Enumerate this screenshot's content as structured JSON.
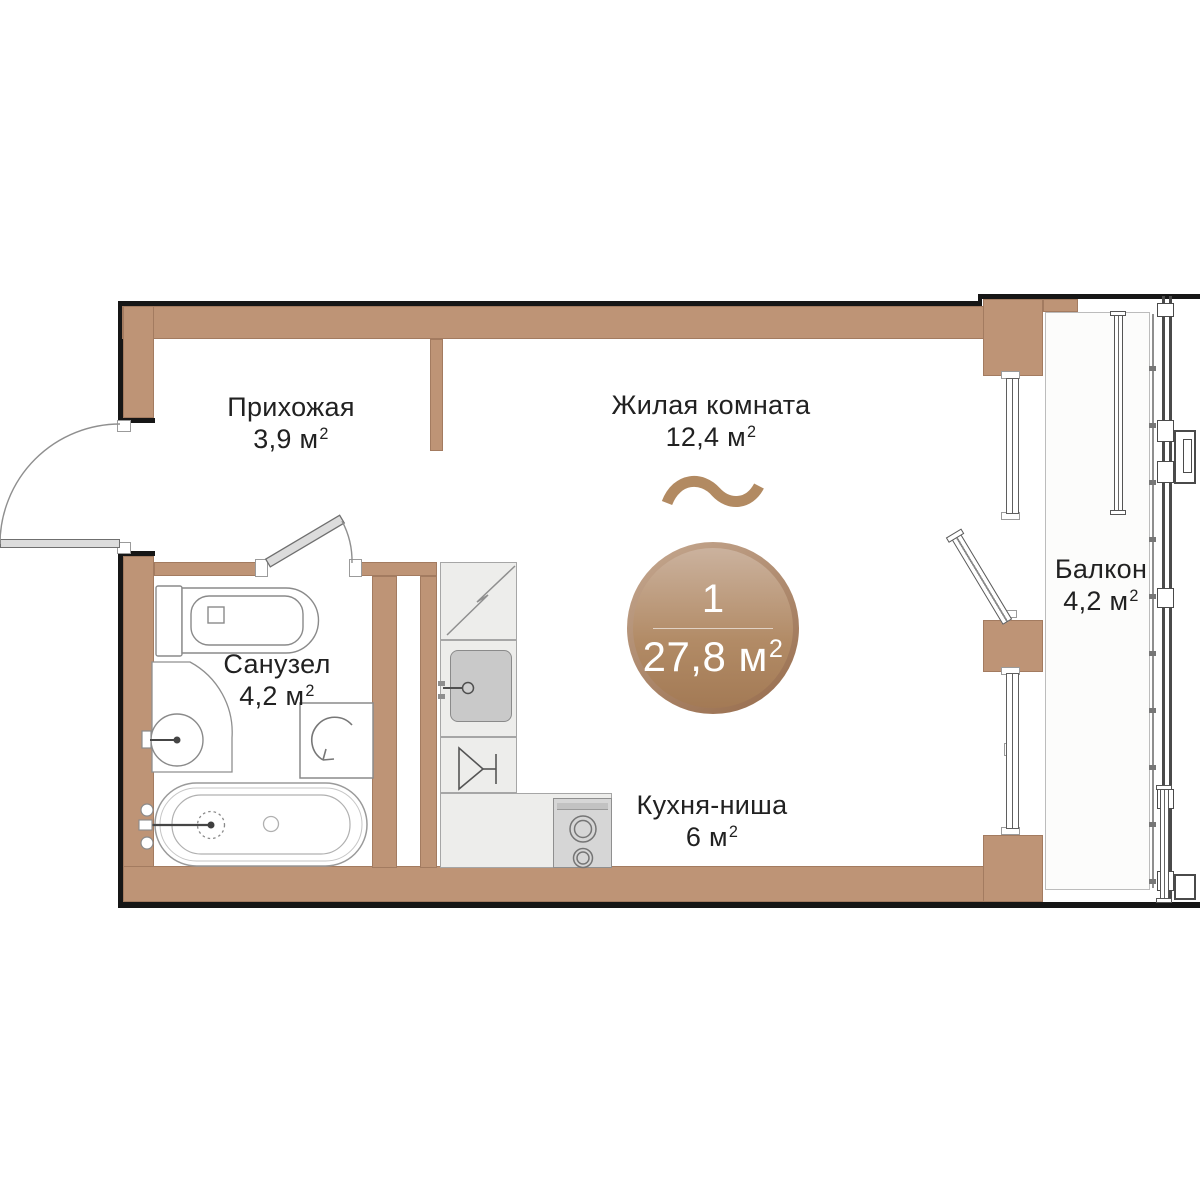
{
  "plan": {
    "rooms": {
      "hallway": {
        "name": "Прихожая",
        "area": "3,9",
        "unit": "м",
        "sup": "2"
      },
      "living": {
        "name": "Жилая комната",
        "area": "12,4",
        "unit": "м",
        "sup": "2"
      },
      "bathroom": {
        "name": "Санузел",
        "area": "4,2",
        "unit": "м",
        "sup": "2"
      },
      "kitchen": {
        "name": "Кухня-ниша",
        "area": "6",
        "unit": "м",
        "sup": "2"
      },
      "balcony": {
        "name": "Балкон",
        "area": "4,2",
        "unit": "м",
        "sup": "2"
      }
    },
    "badge": {
      "rooms_count": "1",
      "area": "27,8",
      "unit": "м",
      "sup": "2"
    },
    "colors": {
      "wall": "#BE9476",
      "outline": "#161616",
      "badge_light": "#CBB29E",
      "badge_dark": "#9C7150",
      "counter": "#EDEDEB",
      "accent_wave": "#B28A62",
      "text": "#212121"
    }
  }
}
